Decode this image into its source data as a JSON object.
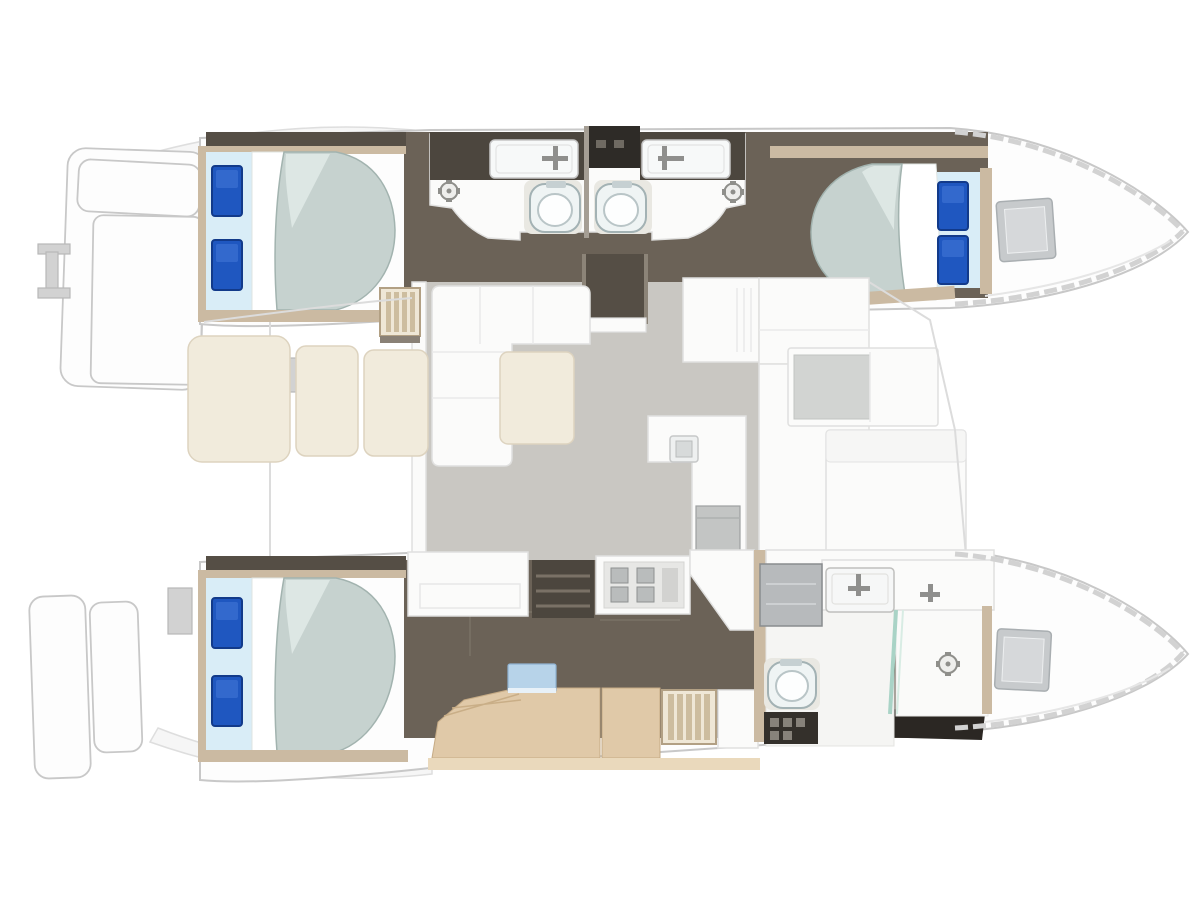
{
  "meta": {
    "description": "Catamaran yacht interior floor plan, top-down view: three double cabins with blue pillows, three bathrooms, central saloon with L-sofa and galley, aft cockpit, twin bows with deck hatches, stern swim platforms with boarding ladder",
    "cabins_visible": 3,
    "heads_visible": 3,
    "toilets_visible": 3,
    "deck_hatches_visible": 2
  },
  "icons": {
    "boarding-ladder": "I-shaped ladder glyph",
    "faucet": "cross bars",
    "shower-drain": "gear circle",
    "stove-burner": "gray square grid",
    "deck-hatch": "nested squares",
    "toilet": "rounded bowl with ring",
    "companionway-steps": "slatted panel"
  },
  "colors": {
    "background": "#ffffff",
    "deck_white": "#fdfdfd",
    "hull_line": "#c8c8c8",
    "walnut_floor": "#6b6257",
    "walnut_dark": "#554e45",
    "near_black": "#2b2723",
    "wood_frame": "#cbbaa2",
    "wood_frame_dark": "#c6ab85",
    "dinette_wood": "#e0c9a8",
    "dinette_light": "#ead9bc",
    "saloon_floor": "#c9c7c2",
    "furniture_white": "#fbfbfa",
    "furniture_line": "#e0e0df",
    "cushion_cream": "#f1ebdc",
    "cushion_line": "#ddd3bf",
    "duvet_sage": "#c6d2cf",
    "duvet_line": "#a2b3af",
    "duvet_highlight": "#dde7e4",
    "sheet_blue": "#d9edf7",
    "pillow_blue": "#1f57c0",
    "pillow_dark": "#123a8a",
    "counter_dark": "#4c463e",
    "appliance_dark": "#2e2b27",
    "porcelain": "#eff4f4",
    "porcelain_line": "#a3b2b4",
    "glass_teal": "#a9d3c6",
    "metal_gray": "#b7babc",
    "hatch_gray": "#c7cacc",
    "table_blue": "#b7d3e9",
    "faint_line": "#dcdcdc"
  }
}
